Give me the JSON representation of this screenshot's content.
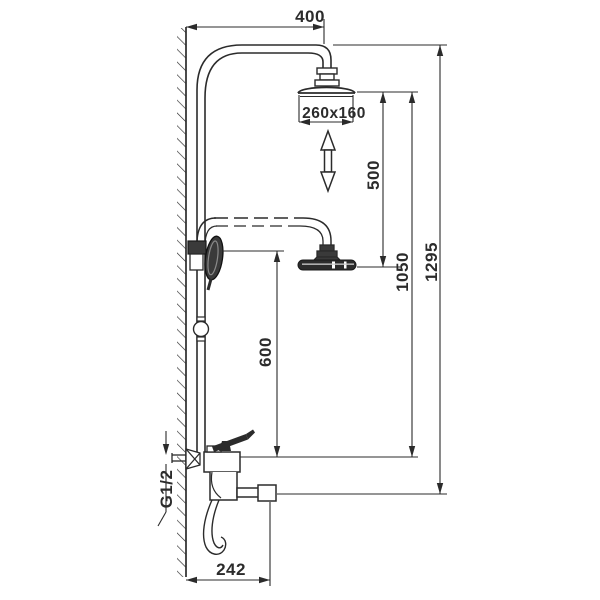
{
  "drawing": {
    "type": "technical-dimension-drawing",
    "subject": "Wall-mounted shower column with overhead rain shower, hand shower and bath spout mixer",
    "background_color": "#ffffff",
    "line_color": "#2b2b2b",
    "dimensions": {
      "arm_offset": "400",
      "head_size": "260x160",
      "head_travel": "500",
      "head_to_mixer": "1050",
      "total_height": "1295",
      "hand_shower_height": "600",
      "spout_reach": "242",
      "inlet_thread": "G1/2"
    },
    "icons": [
      "double-ended-height-adjust-arrow",
      "wall-hatching"
    ]
  }
}
